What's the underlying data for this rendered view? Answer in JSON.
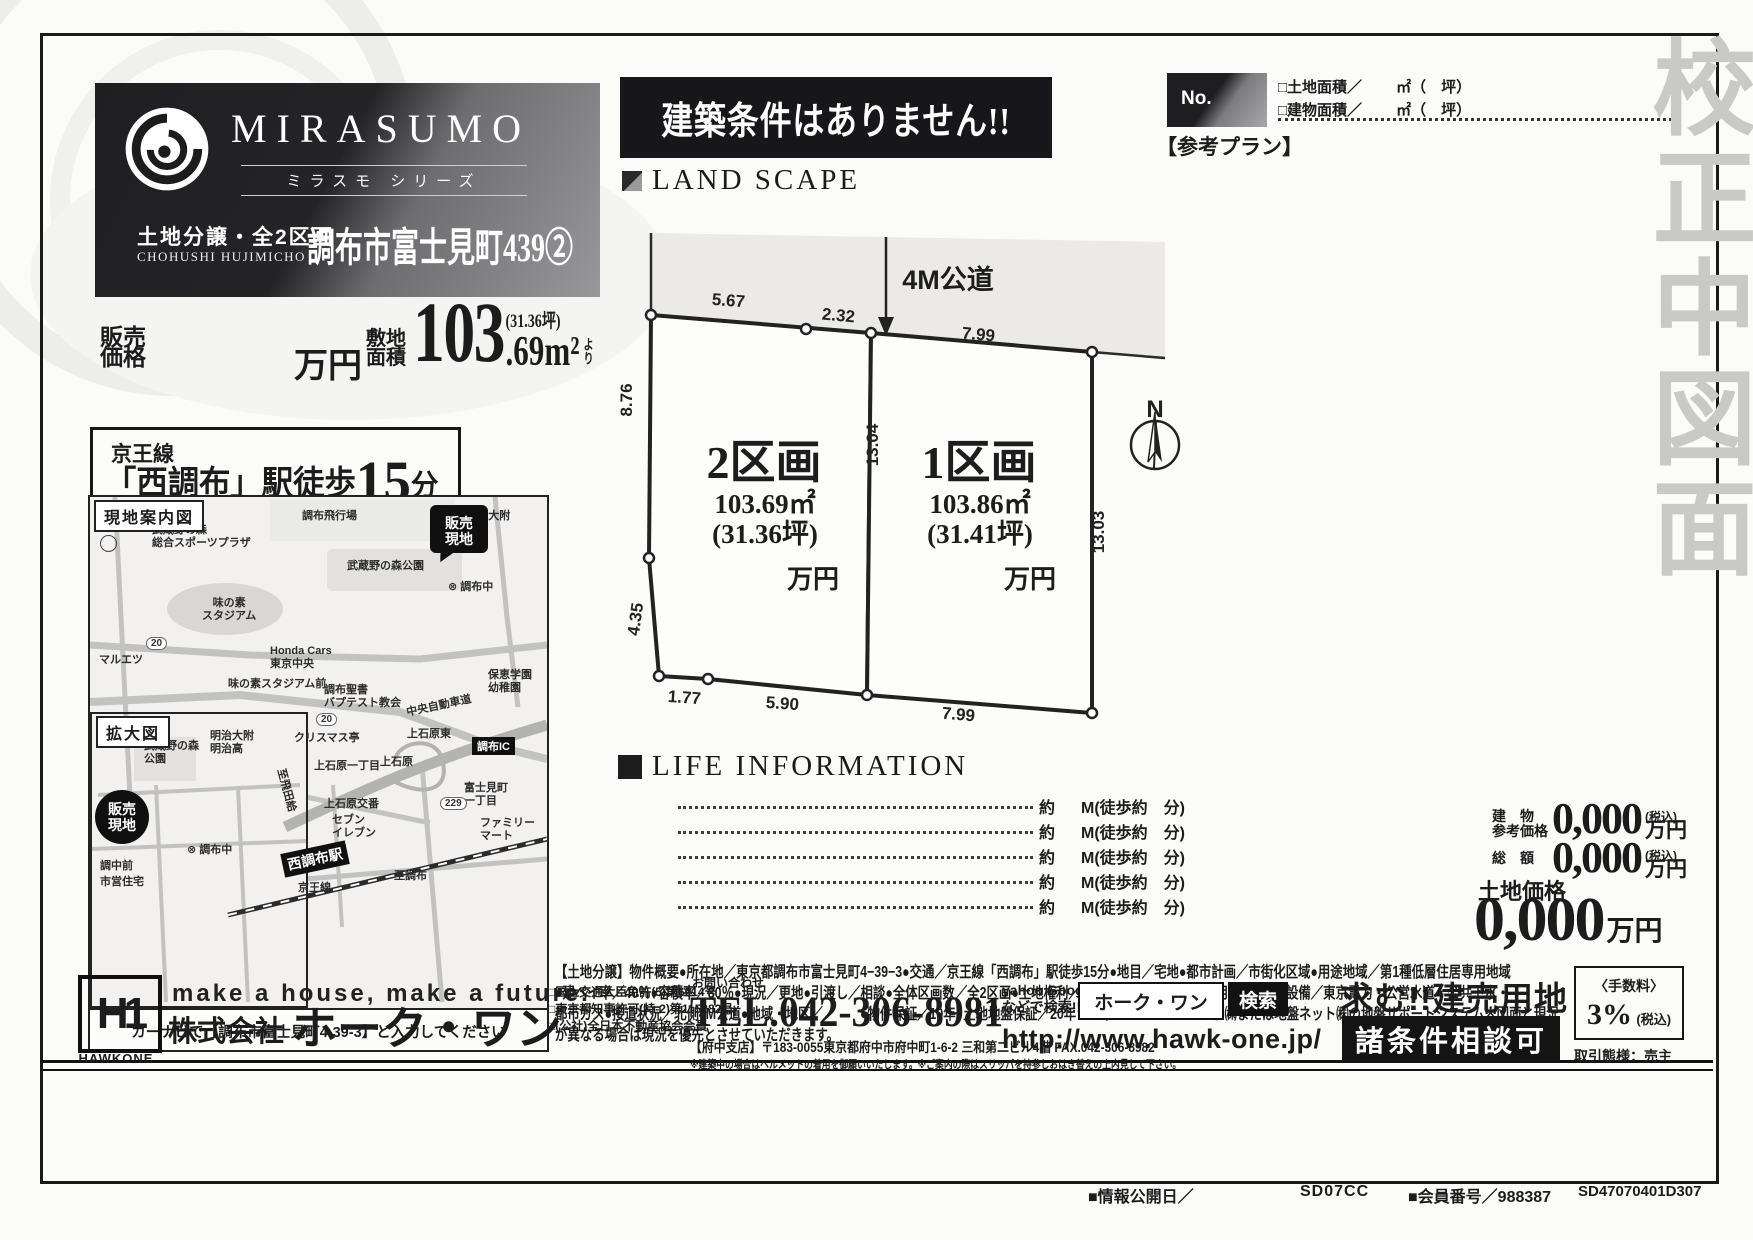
{
  "watermark": "校正中図面",
  "header": {
    "brand": "MIRASUMO",
    "brand_sub": "ミラスモ シリーズ",
    "sale_type": "土地分譲・全2区画",
    "romaji": "CHOHUSHI HUJIMICHO",
    "name": "調布市富士見町439②",
    "banner": "建築条件はありません!!"
  },
  "price": {
    "sale": "販売\n価格",
    "man": "万円",
    "area_label": "敷地\n面積",
    "big": "103",
    "dec": ".69m²",
    "yori": "より",
    "tsubo": "(31.36坪)"
  },
  "access": {
    "line": "京王線",
    "pre": "「西調布」駅徒歩",
    "num": "15",
    "suf": "分"
  },
  "ref_plan": {
    "no": "No.",
    "label": "【参考プラン】",
    "land": "□土地面積／",
    "bldg": "□建物面積／",
    "unit": "㎡（　坪）"
  },
  "landscape": {
    "heading": "LAND SCAPE",
    "road": "4M公道",
    "north": "N",
    "lot2": {
      "name": "2区画",
      "area": "103.69㎡",
      "tsubo": "(31.36坪)",
      "unit": "万円"
    },
    "lot1": {
      "name": "1区画",
      "area": "103.86㎡",
      "tsubo": "(31.41坪)",
      "unit": "万円"
    },
    "dims": {
      "t1": "5.67",
      "t2": "2.32",
      "t3": "7.99",
      "l1": "8.76",
      "l2": "4.35",
      "b1": "1.77",
      "b2": "5.90",
      "b3": "7.99",
      "m": "13.04",
      "r": "13.03"
    }
  },
  "life": {
    "heading": "LIFE INFORMATION",
    "approx": "約",
    "unit": "M(徒歩約　分)"
  },
  "prices": {
    "bldg_l1": "建　物",
    "bldg_l2": "参考価格",
    "v1": "0,000",
    "tax": "(税込)",
    "man": "万円",
    "total_l": "総　額",
    "v2": "0,000",
    "land_l": "土地価格",
    "v3": "0,000",
    "man3": "万円"
  },
  "outline": {
    "lines": [
      "【土地分譲】物件概要●所在地／東京都調布市富士見町4−39−3●交通／京王線「西調布」駅徒歩15分●地目／宅地●都市計画／市街化区域●用途地域／第1種低層住居専用地域",
      "●建ペイ率／40％●容積率／80％●現況／更地●引渡し／相談●全体区画数／全2区画●土地権利／所有権●完成／2025年10月上旬予定●設備／東京電力・公営水道・公共下水・",
      "都市ガス●接道状況／北側4M公道●地域・地区／　　　●物件保証／10年●土地地盤保証／20年・ジャパンホームシールド㈱または地盤ネット㈱の地盤サポートシステム※図面と現況",
      "が異なる場合は現況を優先とさせていただきます。"
    ]
  },
  "map": {
    "title": "現地案内図",
    "zoom_title": "拡大図",
    "north": "N",
    "site_badge": "販売\n現地",
    "station": "西調布駅",
    "ic": "調布IC",
    "navi": "カーナビで【調布市富士見町4-39-3】と入力してください",
    "badges": [
      "20",
      "20",
      "229"
    ],
    "labels": [
      {
        "t": "調布飛行場"
      },
      {
        "t": "武蔵野の森\n総合スポーツプラザ"
      },
      {
        "t": "⊗ 明治大附\n明治高"
      },
      {
        "t": "武蔵野の森公園"
      },
      {
        "t": "⊗ 調布中"
      },
      {
        "t": "味の素\nスタジアム"
      },
      {
        "t": "マルエツ"
      },
      {
        "t": "Honda Cars\n東京中央"
      },
      {
        "t": "味の素スタジアム前"
      },
      {
        "t": "調布聖書\nバプテスト教会"
      },
      {
        "t": "保恵学園\n幼稚園"
      },
      {
        "t": "中央自動車道"
      },
      {
        "t": "クリスマス亭"
      },
      {
        "t": "上石原東"
      },
      {
        "t": "明治大附\n明治高"
      },
      {
        "t": "武蔵野の森\n公園"
      },
      {
        "t": "⊗ 調布中"
      },
      {
        "t": "調中前"
      },
      {
        "t": "市営住宅"
      },
      {
        "t": "上石原一丁目"
      },
      {
        "t": "至飛田給"
      },
      {
        "t": "上石原"
      },
      {
        "t": "上石原交番"
      },
      {
        "t": "セブン\nイレブン"
      },
      {
        "t": "富士見町\n一丁目"
      },
      {
        "t": "ファミリー\nマート"
      },
      {
        "t": "京王線"
      },
      {
        "t": "至調布"
      }
    ]
  },
  "footer": {
    "logo": "H1",
    "logo_text": "HAWKONE",
    "slogan": "make a house, make a future.",
    "company_pre": "株式会社",
    "company": "ホーク・ワン",
    "lic1": "□国土交通大臣免許(5)第6014号",
    "lic2": "□東京都知事許可(特-2)第115282号",
    "lic3": "□(公社)全日本不動産協会会員",
    "contact": "お問い合わせ",
    "tel": "TEL.042-306-8981",
    "branch": "【府中支店】〒183-0055東京都府中市府中町1-6-2 三和第二ビル4階 FAX.042-306-8982",
    "note": "※建築中の場合はヘルメットの着用を御願いいたします。※ご案内の際はスリッパを持参しおはき替えの上内見して下さい。",
    "search_hint1": "yahoo Google",
    "search_hint2": "などで検索!!",
    "search_value": "ホーク・ワン",
    "search_btn": "検索",
    "url": "http://www.hawk-one.jp/",
    "wanted": "求む!!建売用地",
    "nego": "諸条件相談可",
    "fee_label": "〈手数料〉",
    "fee_value": "3%",
    "fee_tax": "(税込)",
    "deal": "取引態様：売主"
  },
  "codes": {
    "c1": "■情報公開日／",
    "c2": "SD07CC",
    "c3": "■会員番号／988387",
    "c4": "SD47070401D307"
  }
}
